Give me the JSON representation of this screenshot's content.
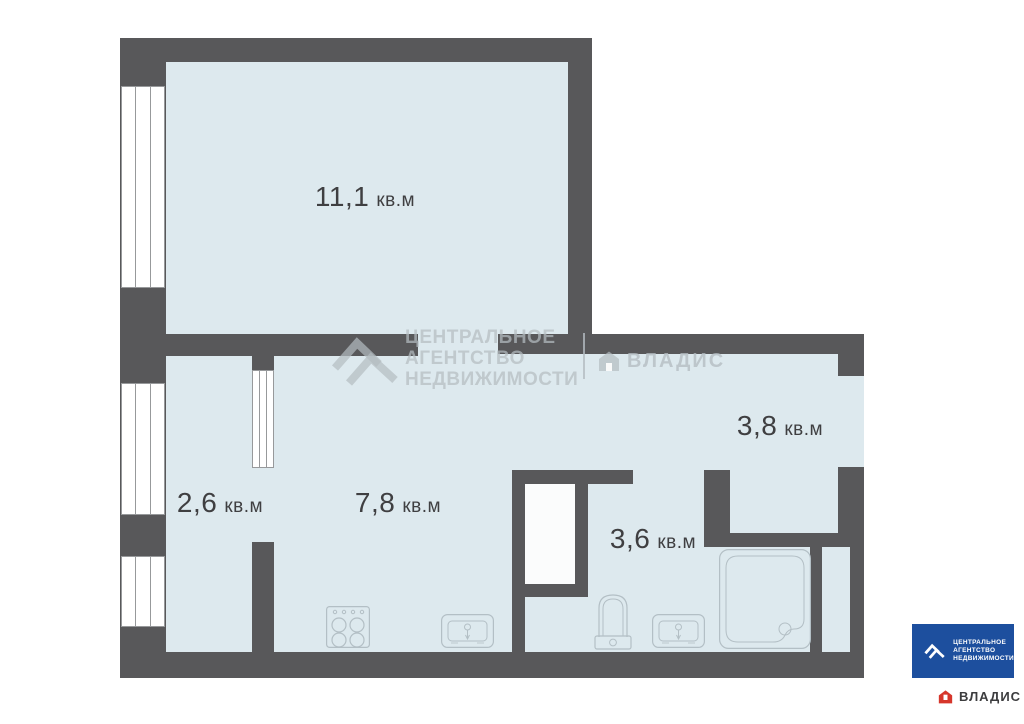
{
  "plan": {
    "type": "apartment-floor-plan",
    "unit_label": "кв.м",
    "total_rooms": 5
  },
  "rooms": [
    {
      "id": "living",
      "area": "11,1",
      "unit": "кв.м"
    },
    {
      "id": "balcony",
      "area": "2,6",
      "unit": "кв.м"
    },
    {
      "id": "kitchen",
      "area": "7,8",
      "unit": "кв.м"
    },
    {
      "id": "hall",
      "area": "3,8",
      "unit": "кв.м"
    },
    {
      "id": "bathroom",
      "area": "3,6",
      "unit": "кв.м"
    }
  ],
  "fixtures": [
    {
      "id": "stove",
      "icon": "stove-icon"
    },
    {
      "id": "kitchen-sink",
      "icon": "sink-icon"
    },
    {
      "id": "toilet",
      "icon": "toilet-icon"
    },
    {
      "id": "bathroom-sink",
      "icon": "sink-icon"
    },
    {
      "id": "shower-tray",
      "icon": "shower-tray-icon"
    }
  ],
  "watermark": {
    "agency_line1": "ЦЕНТРАЛЬНОЕ",
    "agency_line2": "АГЕНТСТВО",
    "agency_line3": "НЕДВИЖИМОСТИ",
    "partner": "ВЛАДИС"
  },
  "logo": {
    "agency_line1": "ЦЕНТРАЛЬНОЕ",
    "agency_line2": "АГЕНТСТВО",
    "agency_line3": "НЕДВИЖИМОСТИ",
    "partner": "ВЛАДИС"
  },
  "colors": {
    "wall": "#58585a",
    "room_fill": "#dde9ee",
    "window_line": "#97999b",
    "fixture_line": "#b3bfc5",
    "label_text": "#3f3f41",
    "logo_blue": "#1d4f9e",
    "logo_red": "#d6362b",
    "watermark": "#b4bcc1"
  }
}
